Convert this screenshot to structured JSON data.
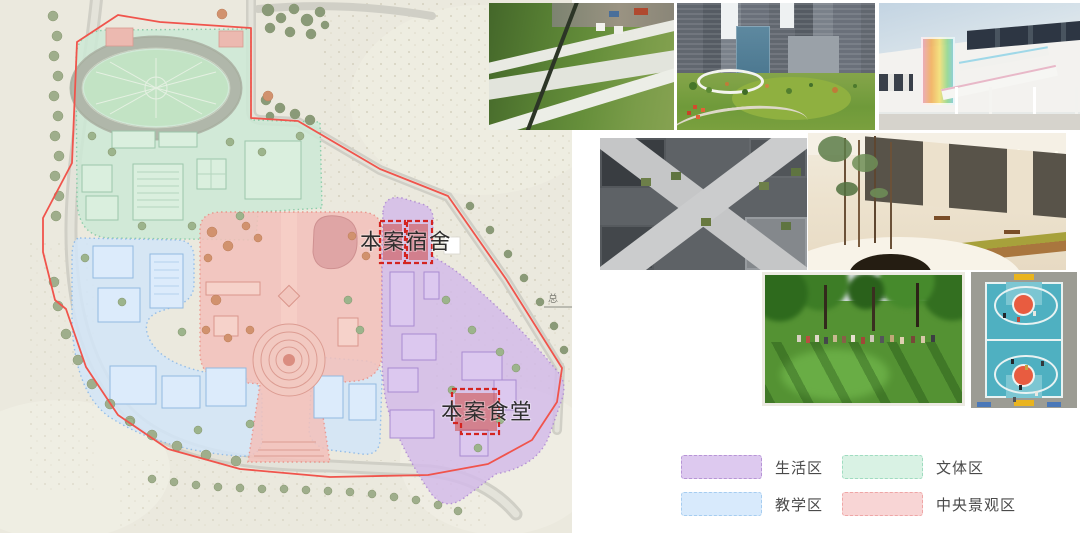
{
  "site_plan": {
    "dormitory_label": "本案宿舍",
    "canteen_label": "本案食堂",
    "compass_label": "总",
    "boundary_color": "#f0544c",
    "zone_colors": {
      "living": "#d4bce9",
      "teaching": "#d3e6f8",
      "culture_sports": "#cde9d6",
      "central_landscape": "#f4c1bb"
    }
  },
  "photos": [
    {
      "id": "green-roof-landscape-aerial"
    },
    {
      "id": "city-park-with-ring-walkway"
    },
    {
      "id": "school-building-rainbow-stair"
    },
    {
      "id": "courtyard-paths-aerial"
    },
    {
      "id": "canteen-interior-trees"
    },
    {
      "id": "park-lawn-gathering"
    },
    {
      "id": "basketball-court-aerial"
    }
  ],
  "legend": {
    "items": [
      {
        "id": "living",
        "label": "生活区",
        "fill": "#ddc9ef",
        "border": "#b794d6"
      },
      {
        "id": "culture-sports",
        "label": "文体区",
        "fill": "#d9f2e4",
        "border": "#9fdcc0"
      },
      {
        "id": "teaching",
        "label": "教学区",
        "fill": "#d8eafc",
        "border": "#a6cdf0"
      },
      {
        "id": "central-landscape",
        "label": "中央景观区",
        "fill": "#f8d5d5",
        "border": "#efa6a6"
      }
    ]
  }
}
